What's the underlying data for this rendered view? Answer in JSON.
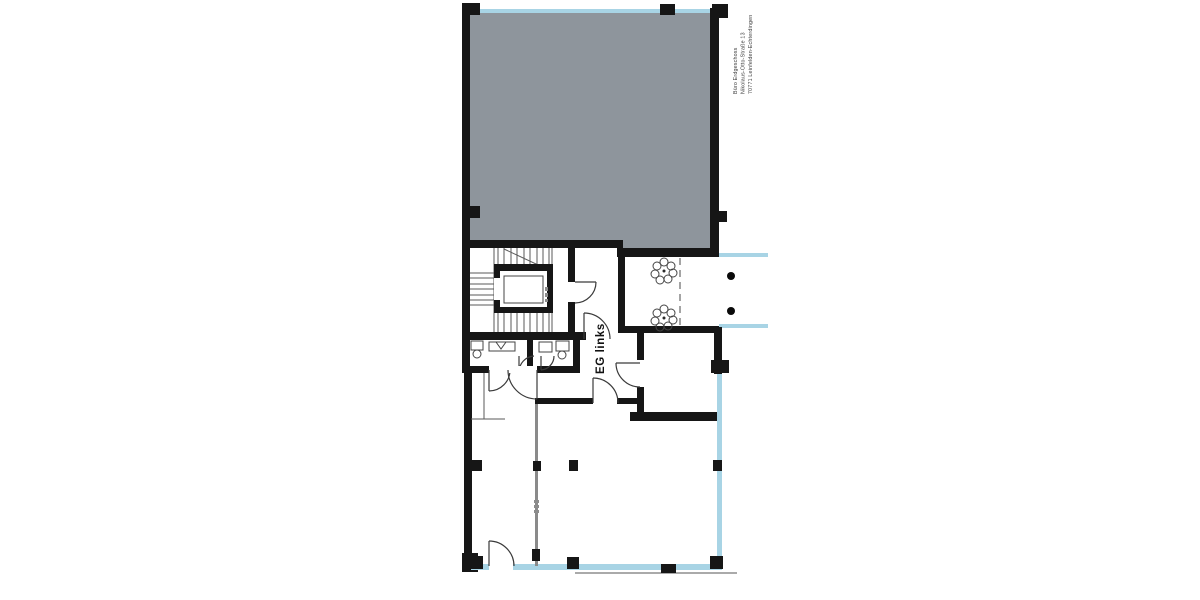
{
  "plan": {
    "labels": {
      "unit": "EG links",
      "address_line1": "Büro Erdgeschoss",
      "address_line2": "Nikolaus-Otto-Straße 13",
      "address_line3": "70771 Leinfelden-Echterdingen"
    },
    "colors": {
      "upper_unit_fill": "#8e959c",
      "glazing": "#a8d4e5",
      "wall": "#161616",
      "background": "#ffffff"
    },
    "features": {
      "trees": 2,
      "freestanding_columns": 2,
      "elevator": 1,
      "stair_flights": 3
    }
  }
}
